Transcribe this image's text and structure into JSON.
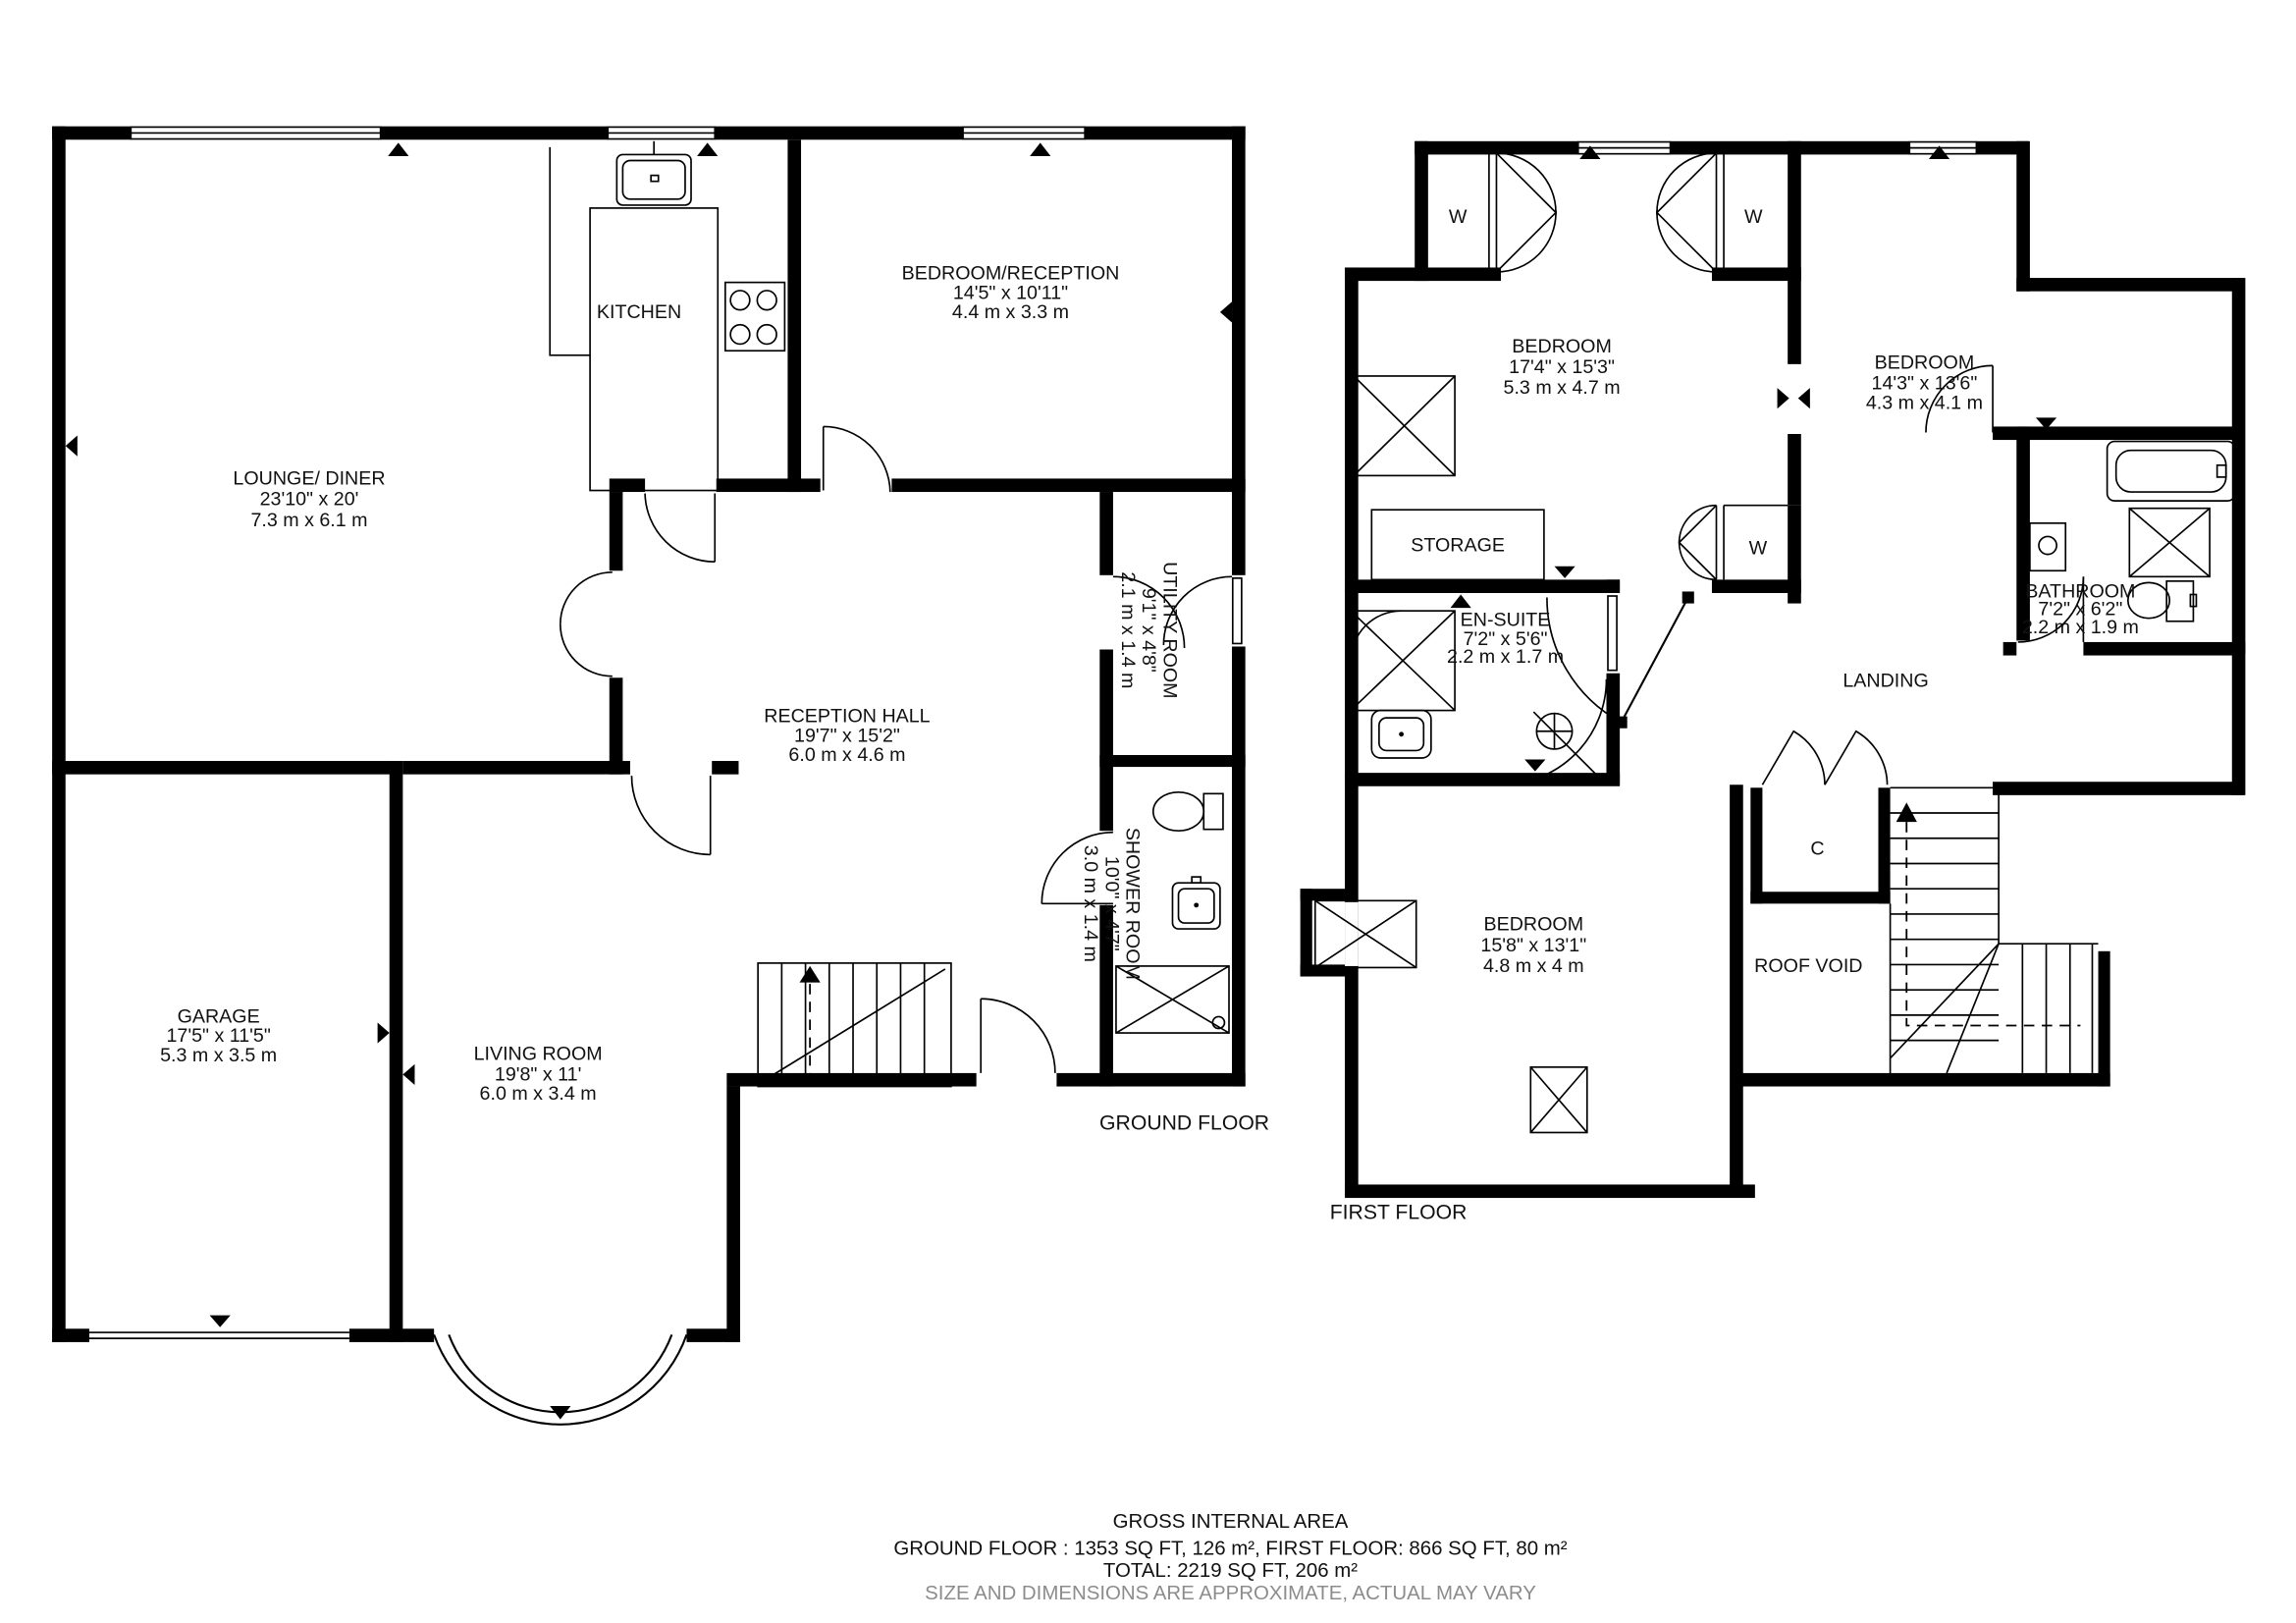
{
  "ground_floor": {
    "floor_label": "GROUND FLOOR",
    "lounge": {
      "name": "LOUNGE/ DINER",
      "imperial": "23'10\" x 20'",
      "metric": "7.3 m x 6.1 m"
    },
    "kitchen": {
      "name": "KITCHEN"
    },
    "bedroom_reception": {
      "name": "BEDROOM/RECEPTION",
      "imperial": "14'5\" x 10'11\"",
      "metric": "4.4 m x 3.3 m"
    },
    "reception_hall": {
      "name": "RECEPTION HALL",
      "imperial": "19'7\" x 15'2\"",
      "metric": "6.0 m x 4.6 m"
    },
    "utility": {
      "name": "UTILITY ROOM",
      "imperial": "9'1\" x 4'8\"",
      "metric": "2.1 m x 1.4 m"
    },
    "shower_room": {
      "name": "SHOWER ROOM",
      "imperial": "10'0\" x 4'7\"",
      "metric": "3.0 m x 1.4 m"
    },
    "garage": {
      "name": "GARAGE",
      "imperial": "17'5\" x 11'5\"",
      "metric": "5.3 m x 3.5 m"
    },
    "living_room": {
      "name": "LIVING ROOM",
      "imperial": "19'8\" x 11'",
      "metric": "6.0 m x 3.4 m"
    }
  },
  "first_floor": {
    "floor_label": "FIRST FLOOR",
    "bedroom1": {
      "name": "BEDROOM",
      "imperial": "17'4\" x 15'3\"",
      "metric": "5.3 m x 4.7 m"
    },
    "bedroom2": {
      "name": "BEDROOM",
      "imperial": "14'3\" x 13'6\"",
      "metric": "4.3 m x 4.1 m"
    },
    "bedroom3": {
      "name": "BEDROOM",
      "imperial": "15'8\" x 13'1\"",
      "metric": "4.8 m x 4 m"
    },
    "bathroom": {
      "name": "BATHROOM",
      "imperial": "7'2\" x 6'2\"",
      "metric": "2.2 m x 1.9 m"
    },
    "ensuite": {
      "name": "EN-SUITE",
      "imperial": "7'2\" x 5'6\"",
      "metric": "2.2 m x 1.7 m"
    },
    "storage": {
      "name": "STORAGE"
    },
    "landing": {
      "name": "LANDING"
    },
    "roof_void": {
      "name": "ROOF VOID"
    },
    "closet": {
      "name": "C"
    },
    "wardrobe": {
      "name": "W"
    }
  },
  "footer": {
    "line1": "GROSS INTERNAL AREA",
    "line2": "GROUND FLOOR : 1353 SQ FT, 126 m², FIRST FLOOR: 866 SQ FT, 80 m²",
    "line3": "TOTAL: 2219 SQ FT, 206 m²",
    "disclaimer": "SIZE AND DIMENSIONS ARE APPROXIMATE, ACTUAL MAY VARY"
  },
  "colors": {
    "wall": "#000000",
    "disclaimer_text": "#8c8c8c"
  }
}
